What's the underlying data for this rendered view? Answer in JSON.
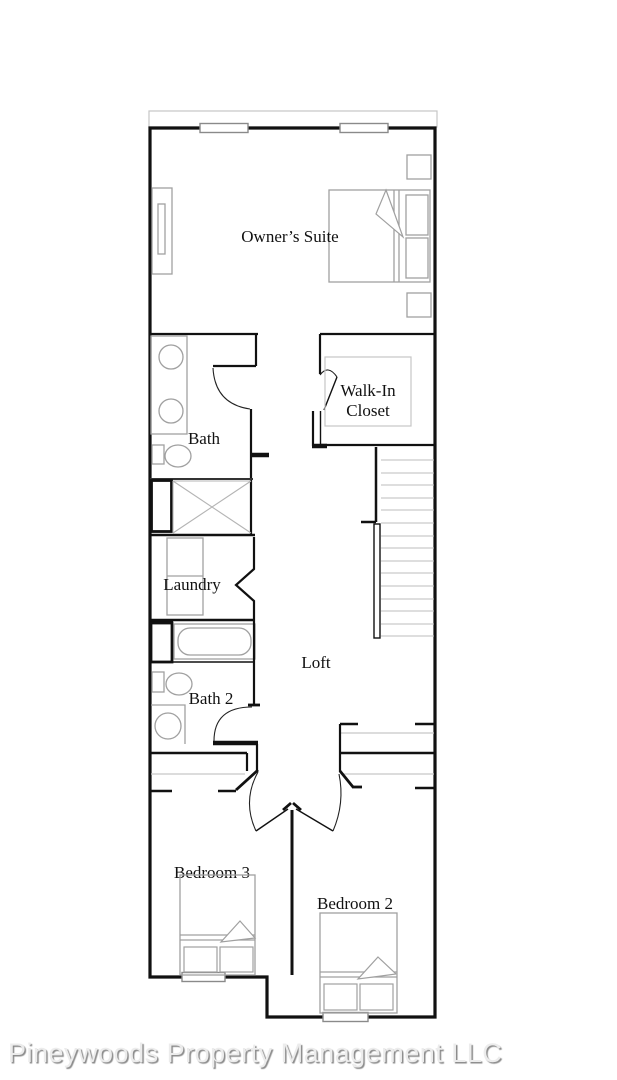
{
  "footer": {
    "watermark": "Pineywoods Property Management LLC"
  },
  "floor_plan": {
    "rooms": {
      "owners_suite": {
        "label": "Owner’s Suite"
      },
      "walk_in_closet": {
        "label_line1": "Walk-In",
        "label_line2": "Closet"
      },
      "bath": {
        "label": "Bath"
      },
      "laundry": {
        "label": "Laundry"
      },
      "loft": {
        "label": "Loft"
      },
      "bath_2": {
        "label": "Bath 2"
      },
      "bedroom_3": {
        "label": "Bedroom 3"
      },
      "bedroom_2": {
        "label": "Bedroom 2"
      }
    },
    "fixtures": [
      "queen-bed",
      "nightstand",
      "dresser",
      "double-sink-vanity",
      "toilet",
      "shower",
      "washer-dryer",
      "bathtub",
      "sink-vanity",
      "staircase",
      "twin-bed",
      "closet-shelf",
      "window",
      "door-swing-arc"
    ],
    "stairs": {
      "treads": 15
    },
    "colors": {
      "wall": "#111111",
      "fixture": "#a0a0a0",
      "shelf": "#c6c6c6",
      "stair_tread": "#bcbcbc",
      "window_frame": "#8a8a8a",
      "watermark_text": "#ececec",
      "watermark_shadow": "#8a8a8a",
      "background": "#ffffff"
    }
  }
}
